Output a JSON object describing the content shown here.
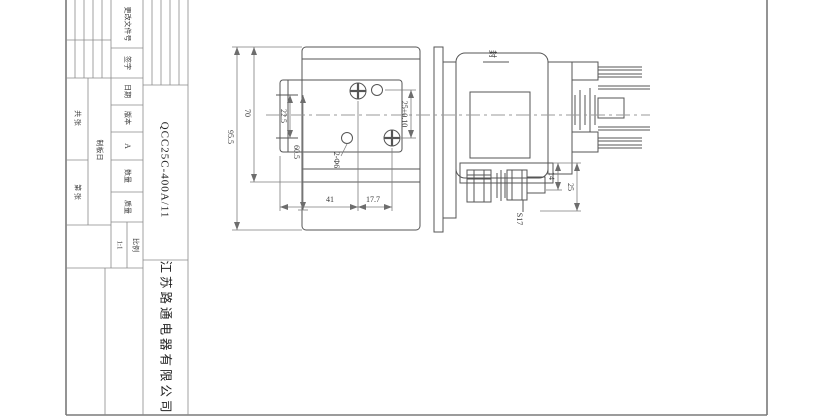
{
  "sheet": {
    "part_number": "QCC25C-400A/11",
    "company": "江苏路通电器有限公司",
    "title_block": {
      "change_doc_no": "更改文件号",
      "signature": "签字",
      "date": "日期",
      "version_label": "版本",
      "version_value": "A",
      "quantity_label": "数量",
      "mass_label": "质量",
      "scale_label": "比例",
      "scale_value": "1:1",
      "plate_date": "制板日",
      "sheets_total": "共 张",
      "sheet_no": "第 张"
    },
    "drawing": {
      "dim_overall_height": "95.5",
      "dim_height_70": "70",
      "dim_height_22_5": "22.5",
      "dim_height_60_5": "60.5",
      "dim_holes": "2-Φ6",
      "dim_width_41": "41",
      "dim_width_17_7": "17.7",
      "dim_pitch_25": "25±0.10",
      "dim_side_14": "14",
      "dim_side_25": "25",
      "dim_hex": "S17",
      "seal_mark": "封"
    },
    "colors": {
      "border": "#7a7a7a",
      "grid": "#8a8a8a",
      "line": "#555555",
      "dimline": "#7d7d7d",
      "centerline": "#9a9a9a"
    }
  }
}
